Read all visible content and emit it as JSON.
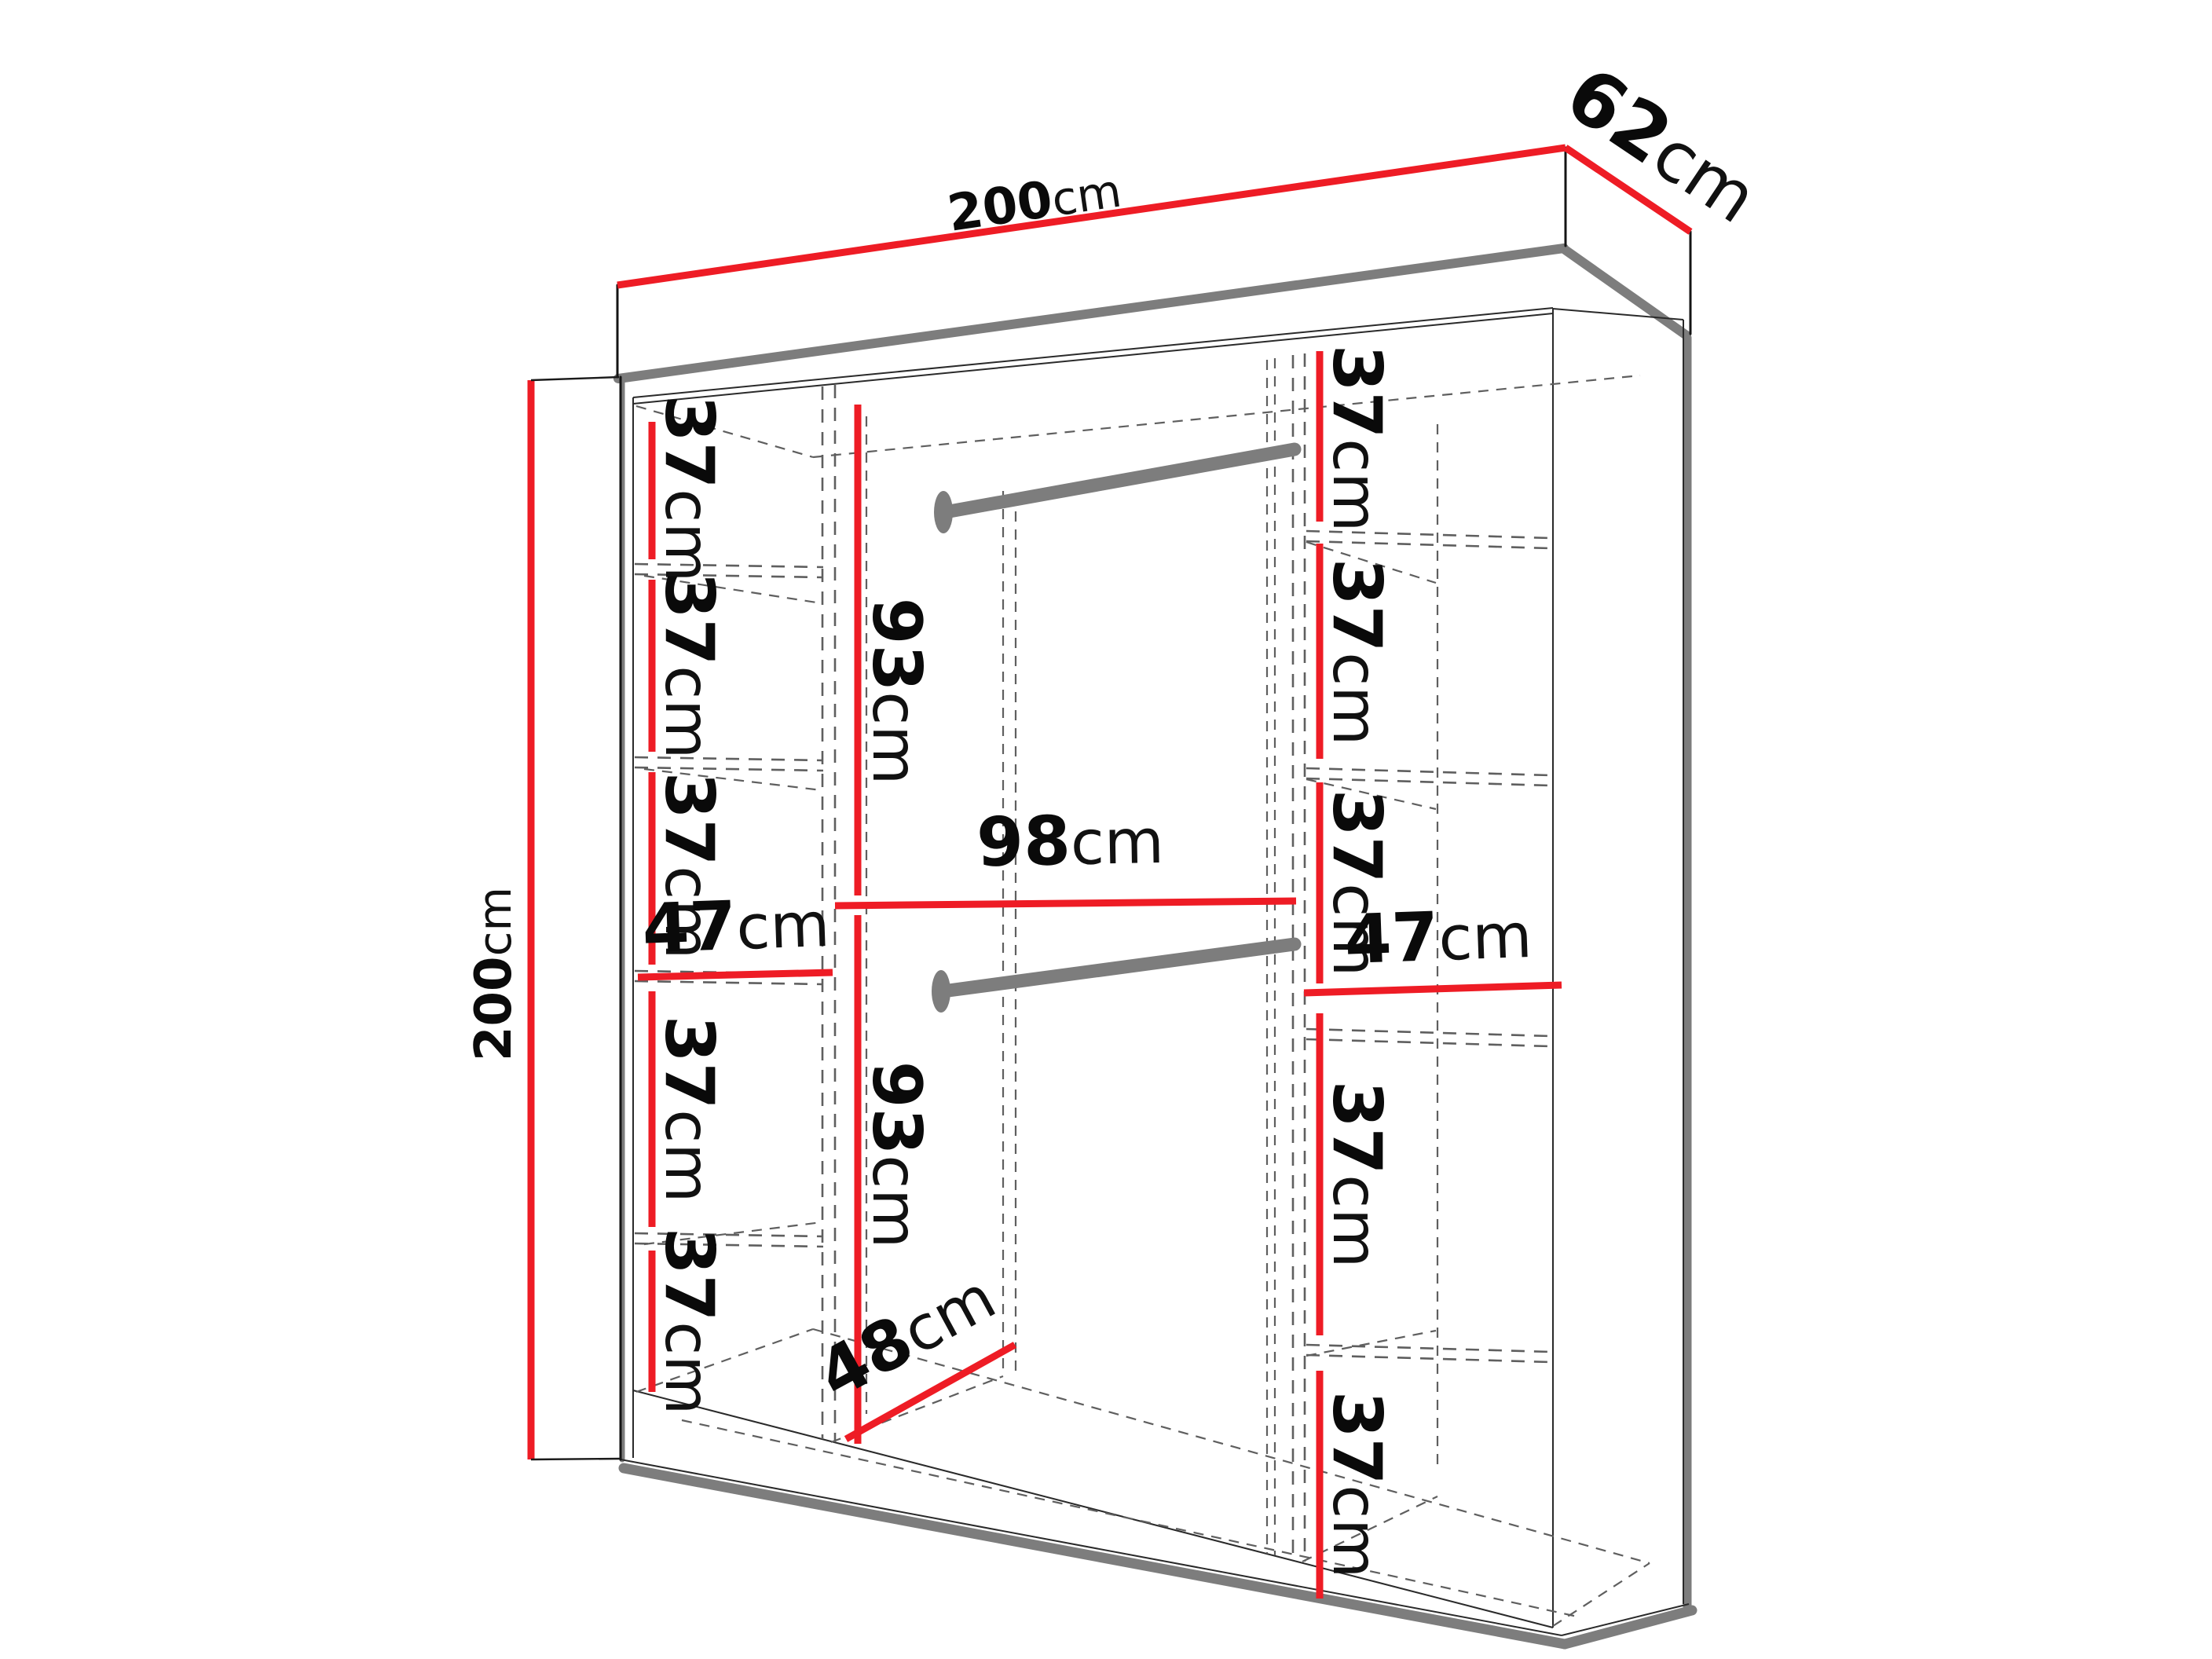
{
  "title": "Wardrobe interior dimension diagram",
  "unit": "cm",
  "colors": {
    "accent_red": "#ee1c25",
    "shadow_gray": "#7d7d7d",
    "rod_gray": "#7d7d7d",
    "edge_black": "#141414",
    "dash_gray": "#5f5f5f",
    "label_black": "#0a0a0a",
    "background": "#ffffff"
  },
  "labels": {
    "top_width": {
      "value": "200",
      "unit": "cm"
    },
    "top_depth": {
      "value": "62",
      "unit": "cm"
    },
    "left_height": {
      "value": "200",
      "unit": "cm"
    },
    "left_gap_1": {
      "value": "37",
      "unit": "cm"
    },
    "left_gap_2": {
      "value": "37",
      "unit": "cm"
    },
    "left_gap_3": {
      "value": "37",
      "unit": "cm"
    },
    "left_col_width": {
      "value": "47",
      "unit": "cm"
    },
    "left_gap_4": {
      "value": "37",
      "unit": "cm"
    },
    "left_gap_5": {
      "value": "37",
      "unit": "cm"
    },
    "mid_upper_height": {
      "value": "93",
      "unit": "cm"
    },
    "mid_width": {
      "value": "98",
      "unit": "cm"
    },
    "mid_lower_height": {
      "value": "93",
      "unit": "cm"
    },
    "floor_depth": {
      "value": "48",
      "unit": "cm"
    },
    "right_gap_1": {
      "value": "37",
      "unit": "cm"
    },
    "right_gap_2": {
      "value": "37",
      "unit": "cm"
    },
    "right_gap_3": {
      "value": "37",
      "unit": "cm"
    },
    "right_col_width": {
      "value": "47",
      "unit": "cm"
    },
    "right_gap_4": {
      "value": "37",
      "unit": "cm"
    },
    "right_gap_5": {
      "value": "37",
      "unit": "cm"
    }
  }
}
